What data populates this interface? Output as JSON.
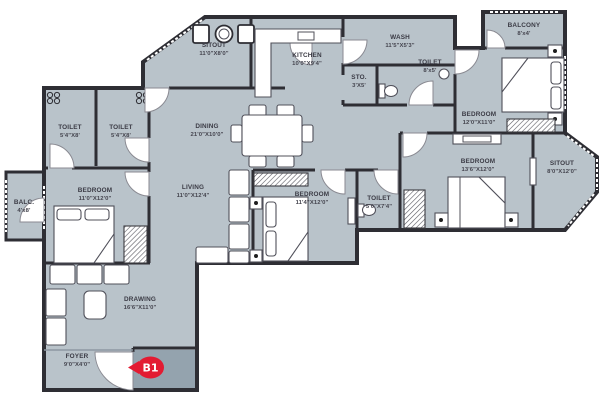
{
  "badge": {
    "label": "B1"
  },
  "colors": {
    "floor": "#b9c3ca",
    "wall": "#2e2e34",
    "entry_floor": "#94a3ae",
    "badge_red": "#e31b32",
    "furniture": "#ffffff",
    "label_text": "#3b3b45"
  },
  "rooms": {
    "sitout_top": {
      "name": "SITOUT",
      "dims": "11'0\"X8'0\""
    },
    "kitchen": {
      "name": "KITCHEN",
      "dims": "10'0\"X9'4\""
    },
    "wash": {
      "name": "WASH",
      "dims": "11'5\"X5'3\""
    },
    "sto": {
      "name": "STO.",
      "dims": "3'X5'"
    },
    "toilet_top": {
      "name": "TOILET",
      "dims": "8'x5'"
    },
    "balcony_top_right": {
      "name": "BALCONY",
      "dims": "8'x4'"
    },
    "bedroom_top_right": {
      "name": "BEDROOM",
      "dims": "12'0\"X11'0\""
    },
    "toilet_left_1": {
      "name": "TOILET",
      "dims": "5'4\"X8'"
    },
    "toilet_left_2": {
      "name": "TOILET",
      "dims": "5'4\"X8'"
    },
    "dining": {
      "name": "DINING",
      "dims": "21'0\"X10'0\""
    },
    "living": {
      "name": "LIVING",
      "dims": "11'0\"X12'4\""
    },
    "bedroom_left": {
      "name": "BEDROOM",
      "dims": "11'0\"X12'0\""
    },
    "bedroom_mid": {
      "name": "BEDROOM",
      "dims": "11'4\"X12'0\""
    },
    "toilet_mid": {
      "name": "TOILET",
      "dims": "5'0\"X7'4\""
    },
    "bedroom_right": {
      "name": "BEDROOM",
      "dims": "13'6\"X12'0\""
    },
    "sitout_right": {
      "name": "SITOUT",
      "dims": "8'0\"X12'0\""
    },
    "balc_left": {
      "name": "BALC.",
      "dims": "4'x8'"
    },
    "drawing": {
      "name": "DRAWING",
      "dims": "16'6\"X11'0\""
    },
    "foyer": {
      "name": "FOYER",
      "dims": "9'0\"X4'0\""
    }
  }
}
